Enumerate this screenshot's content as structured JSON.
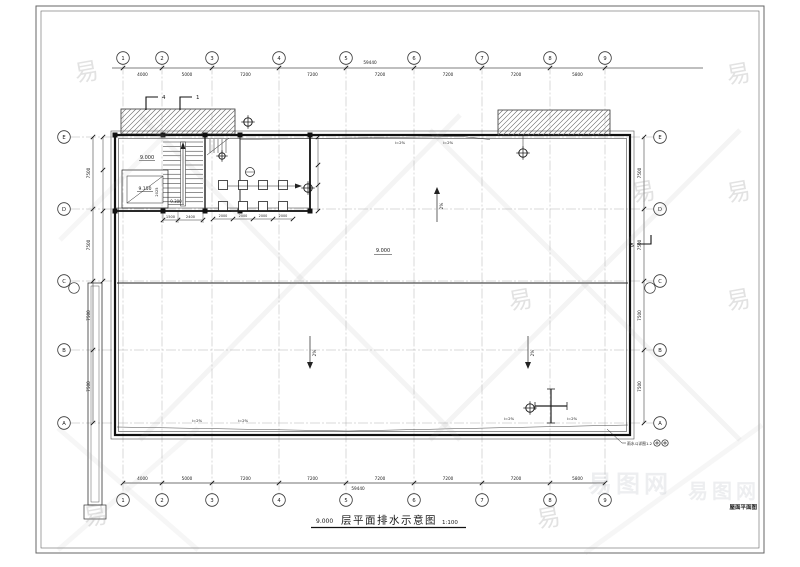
{
  "axes": {
    "columns": [
      "1",
      "2",
      "3",
      "4",
      "5",
      "6",
      "7",
      "8",
      "9"
    ],
    "rows": [
      "E",
      "D",
      "C",
      "B",
      "A"
    ]
  },
  "dims": {
    "top": [
      "4000",
      "5000",
      "7200",
      "7200",
      "7200",
      "7200",
      "7200",
      "5800"
    ],
    "bottom": [
      "4000",
      "5000",
      "7200",
      "7200",
      "7200",
      "7200",
      "7200",
      "5800"
    ],
    "left": [
      "7500",
      "7500",
      "7500",
      "7500"
    ],
    "right": [
      "7500",
      "7500",
      "7500",
      "7500"
    ],
    "total": "59440",
    "stair": [
      "1500",
      "2400"
    ],
    "stair_rise": "2025",
    "grid": [
      "2000",
      "2000",
      "2000",
      "2000"
    ]
  },
  "levels": {
    "main": "9.000",
    "stair_mid": "9.150",
    "stair_top": "9.300"
  },
  "slopes": {
    "pct": "2%",
    "ipct": "i=2%"
  },
  "sections": {
    "s1": "1",
    "s4": "4",
    "s5": "5"
  },
  "notes": {
    "drain": "雨水斗详图1.2"
  },
  "title": {
    "elevation": "9.000",
    "text": "层平面排水示意图",
    "scale": "1:100"
  },
  "corner_label": "屋面平面图",
  "watermark": {
    "char": "易",
    "logo": "易图网"
  }
}
